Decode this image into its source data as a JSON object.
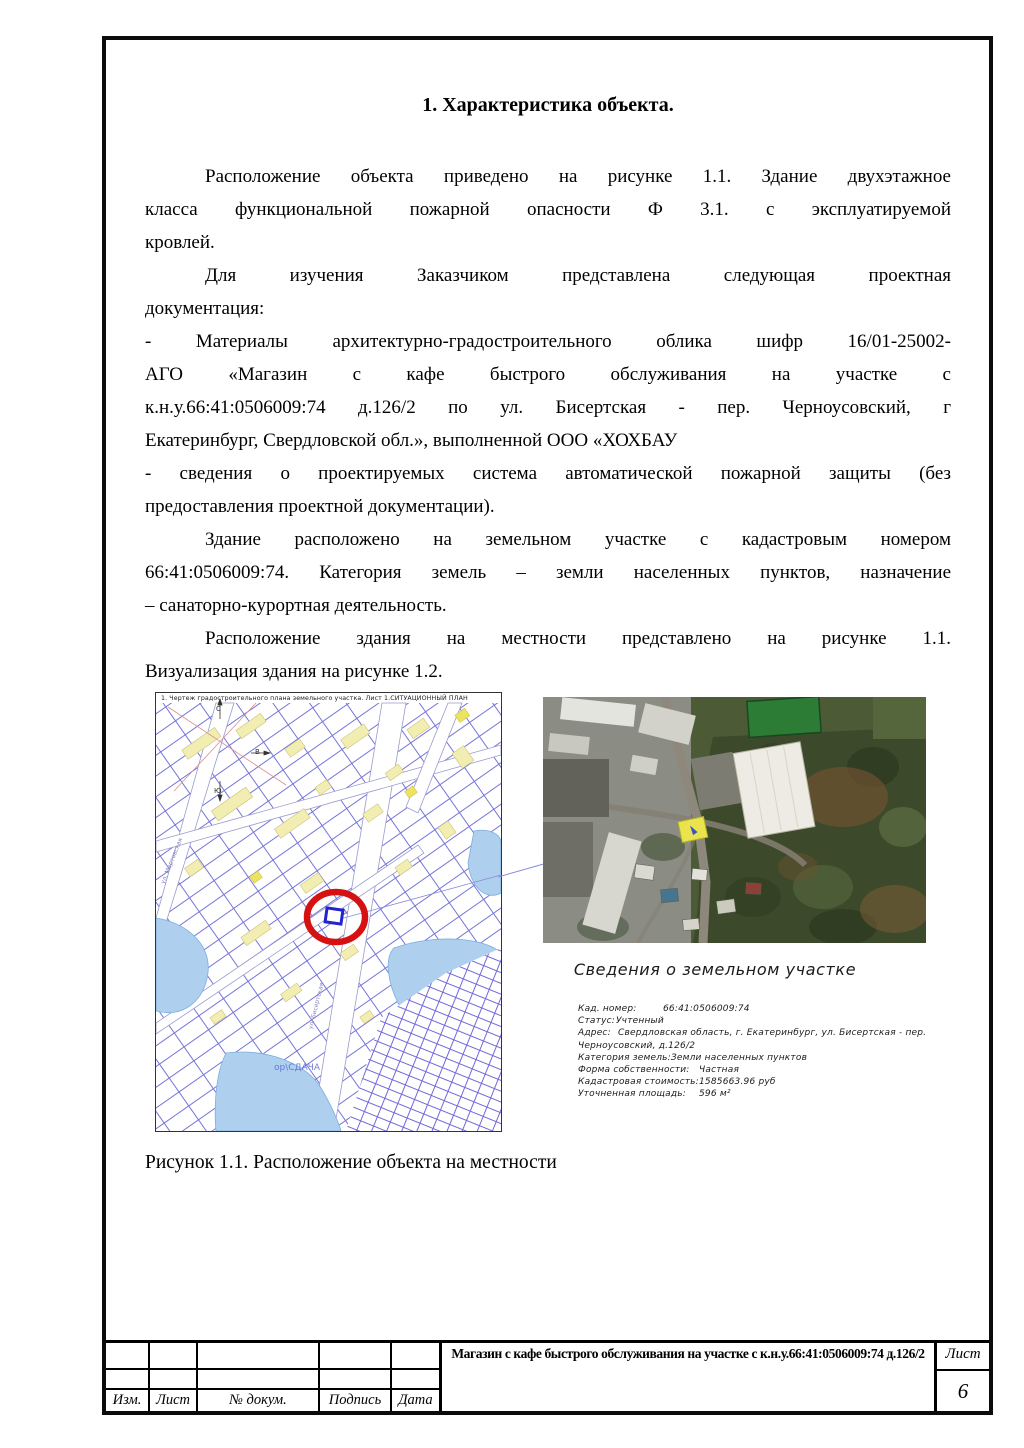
{
  "doc": {
    "heading": "1. Характеристика объекта.",
    "paragraphs": [
      [
        "Расположение объекта приведено на рисунке 1.1. Здание двухэтажное",
        "класса функциональной пожарной опасности Ф 3.1. с эксплуатируемой",
        "кровлей."
      ],
      [
        "Для изучения Заказчиком представлена следующая проектная",
        "документация:"
      ],
      [
        "- Материалы архитектурно-градостроительного облика шифр 16/01-25002-",
        "АГО «Магазин с кафе быстрого обслуживания на участке с",
        "к.н.у.66:41:0506009:74 д.126/2 по ул. Бисертская - пер. Черноусовский, г",
        "Екатеринбург, Свердловской обл.», выполненной ООО «ХОХБАУ"
      ],
      [
        "- сведения о проектируемых система автоматической пожарной защиты (без",
        "предоставления проектной документации)."
      ],
      [
        "Здание расположено на земельном участке с кадастровым номером",
        "66:41:0506009:74. Категория земель – земли населенных пунктов, назначение",
        "– санаторно-курортная деятельность."
      ],
      [
        "Расположение здания на местности представлено на рисунке 1.1.",
        "Визуализация здания на рисунке 1.2."
      ]
    ],
    "caption": "Рисунок 1.1. Расположение объекта на местности"
  },
  "map": {
    "header": "1. Чертеж градостроительного плана земельного участка. Лист 1.СИТУАЦИОННЫЙ ПЛАН",
    "compass": {
      "north": "С",
      "south": "Ю",
      "east": "В"
    },
    "street_1": "ул. Мартовская",
    "street_2": "ул. Бисертская",
    "watermark": "ор\\СДАЧА"
  },
  "parcel": {
    "title": "Сведения о земельном участке",
    "rows": [
      {
        "label": "Кад. номер:",
        "value": "66:41:0506009:74"
      },
      {
        "label": "Статус:",
        "value": "Учтенный"
      },
      {
        "label": "Адрес:",
        "value": "Свердловская область, г. Екатеринбург, ул. Бисертская - пер. Черноусовский, д.126/2"
      },
      {
        "label": "Категория земель:",
        "value": "Земли населенных пунктов"
      },
      {
        "label": "Форма собственности:",
        "value": "Частная"
      },
      {
        "label": "Кадастровая стоимость:",
        "value": "1585663.96 руб"
      },
      {
        "label": "Уточненная площадь:",
        "value": "596 м²"
      }
    ]
  },
  "footer": {
    "columns": [
      "Изм.",
      "Лист",
      "№ докум.",
      "Подпись",
      "Дата"
    ],
    "doc_title": "Магазин с кафе быстрого обслуживания на участке с к.н.у.66:41:0506009:74 д.126/2",
    "sheet_label": "Лист",
    "sheet_number": "6"
  },
  "colors": {
    "parcel_line_blue": "#5252cf",
    "water_blue": "#aed0ee",
    "building_yellow": "#f2edb0",
    "highlight_red": "#d61111",
    "sat_parcel_yellow": "#e9e44e"
  }
}
